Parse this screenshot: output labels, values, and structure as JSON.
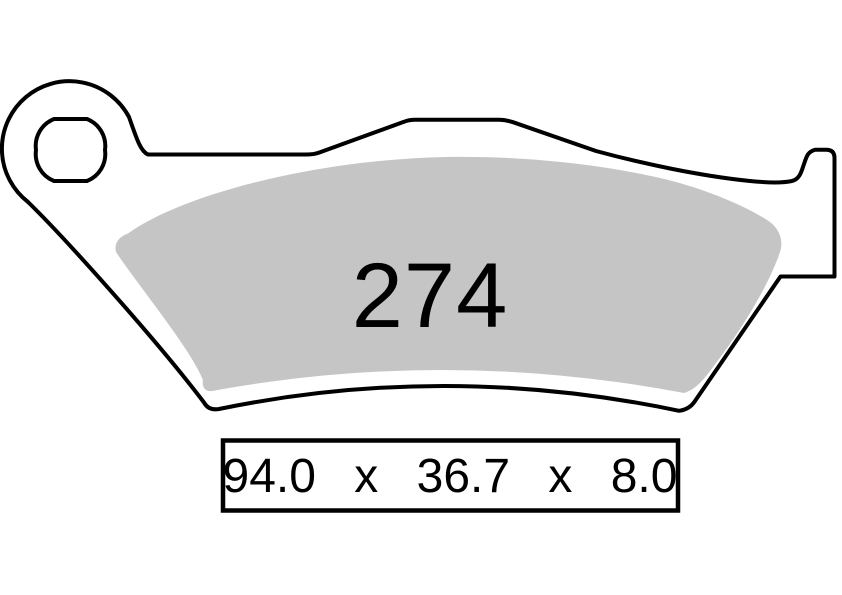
{
  "diagram": {
    "part_number": "274",
    "dimensions": {
      "width": "94.0",
      "separator1": "x",
      "height": "36.7",
      "separator2": "x",
      "thickness": "8.0",
      "label": "94.0 x 36.7 x 8.0"
    },
    "colors": {
      "outline": "#000000",
      "friction_material": "#c5c5c5",
      "backing_plate": "#ffffff",
      "background": "#ffffff"
    }
  }
}
